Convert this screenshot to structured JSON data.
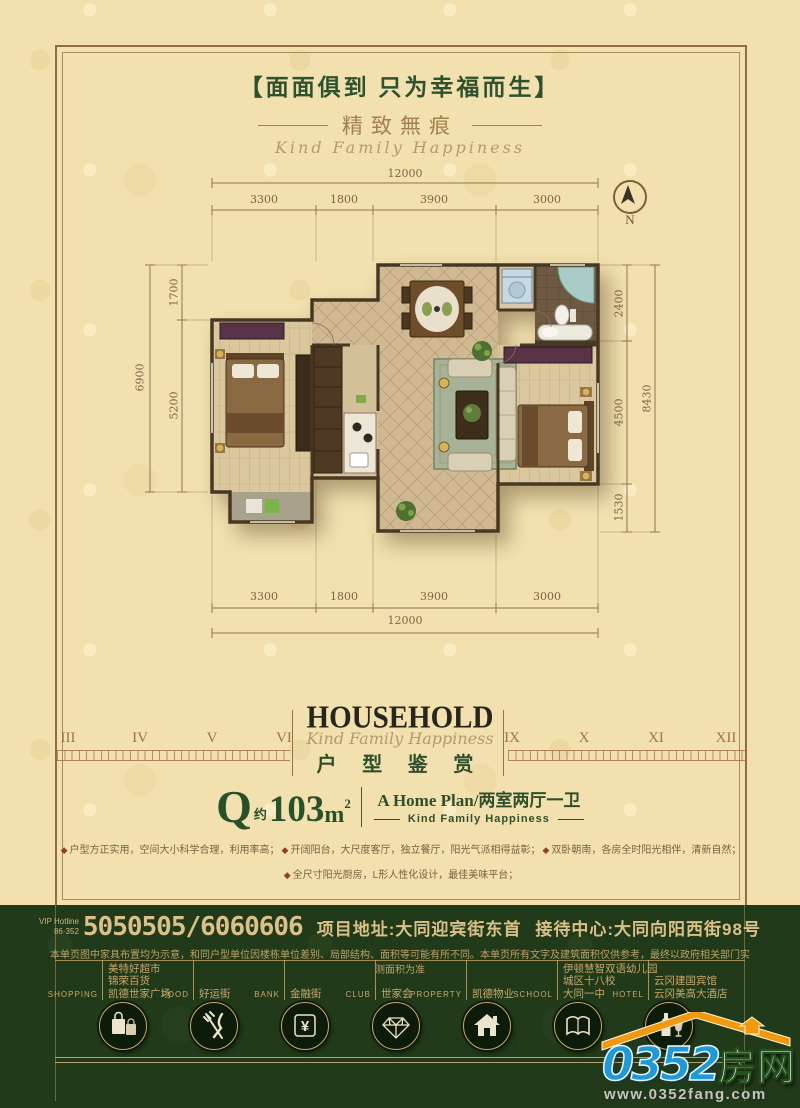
{
  "header": {
    "title": "【面面俱到 只为幸福而生】",
    "subtitle": "精致無痕",
    "script": "Kind Family Happiness"
  },
  "compass": {
    "label": "N"
  },
  "plan": {
    "dims": {
      "top_total": "12000",
      "top_segments": [
        "3300",
        "1800",
        "3900",
        "3000"
      ],
      "bottom_segments": [
        "3300",
        "1800",
        "3900",
        "3000"
      ],
      "bottom_total": "12000",
      "left_total": "6900",
      "left_segments": [
        "1700",
        "5200"
      ],
      "right_segments": [
        "2400",
        "4500",
        "1530"
      ],
      "right_total": "8430"
    }
  },
  "ruler": {
    "left": [
      "III",
      "IV",
      "V",
      "VI"
    ],
    "right": [
      "IX",
      "X",
      "XI",
      "XII"
    ]
  },
  "title_block": {
    "en": "HOUSEHOLD",
    "script": "Kind Family Happiness",
    "cn": "户 型 鉴 赏"
  },
  "unit": {
    "letter": "Q",
    "approx": "约",
    "area": "103",
    "area_unit": "m",
    "area_sup": "2",
    "plan_line": "A Home Plan/两室两厅一卫",
    "tagline": "Kind Family Happiness"
  },
  "features": {
    "bullet": "◆",
    "items": [
      "户型方正实用，空间大小科学合理，利用率高；",
      "开阔阳台，大尺度客厅，独立餐厅，阳光气派相得益彰；",
      "双卧朝南，各房全时阳光相伴，清新自然；",
      "全尺寸阳光厨房，L形人性化设计，最佳美味平台；"
    ]
  },
  "footer": {
    "hotline_label_1": "VIP Hotline",
    "hotline_label_2": "86·352",
    "phone": "5050505/6060606",
    "address": "项目地址:大同迎宾街东首",
    "reception": "接待中心:大同向阳西街98号",
    "disclaimer": "本单页图中家具布置均为示意，和同户型单位因楼栋单位差别、局部结构、面积等可能有所不同。本单页所有文字及建筑面积仅供参考，最终以政府相关部门实测面积为准",
    "groups": [
      {
        "category": "SHOPPING",
        "icon": "shopping-bags-icon",
        "labels": [
          "美特好超市",
          "锦荣百货",
          "凯德世家广场"
        ]
      },
      {
        "category": "FOOD",
        "icon": "fork-knife-icon",
        "labels": [
          "好运街"
        ]
      },
      {
        "category": "BANK",
        "icon": "yuan-icon",
        "glyph": "¥",
        "labels": [
          "金融街"
        ]
      },
      {
        "category": "CLUB",
        "icon": "diamond-icon",
        "labels": [
          "世家会"
        ]
      },
      {
        "category": "PROPERTY",
        "icon": "house-icon",
        "labels": [
          "凯德物业"
        ]
      },
      {
        "category": "SCHOOL",
        "icon": "open-book-icon",
        "labels": [
          "伊顿慧智双语幼儿园",
          "城区十八校",
          "大同一中"
        ]
      },
      {
        "category": "HOTEL",
        "icon": "bottle-glass-icon",
        "labels": [
          "云冈建国宾馆",
          "云冈美高大酒店"
        ]
      }
    ]
  },
  "logo": {
    "brand": "0352",
    "suffix": "房网",
    "url": "www.0352fang.com"
  }
}
